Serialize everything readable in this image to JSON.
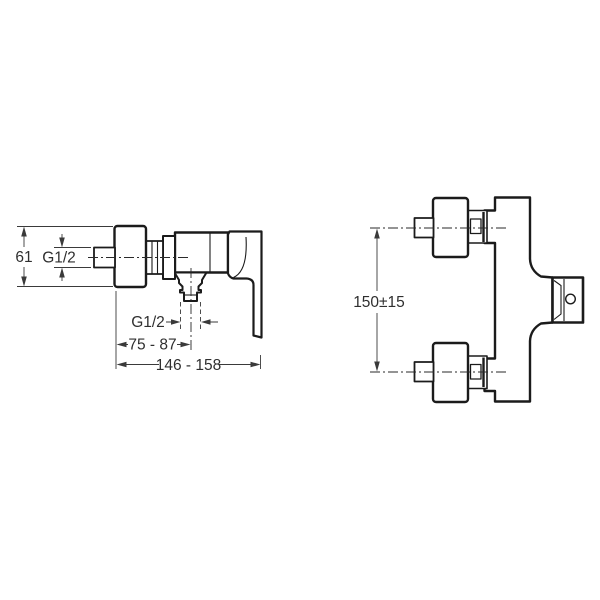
{
  "page": {
    "background": "#ffffff"
  },
  "drawing": {
    "line_color": "#1b1b1b",
    "text_color": "#2f2f2f",
    "side_view": {
      "dim_flange_height": "61",
      "dim_inlet_thread": "G1/2",
      "dim_outlet_thread": "G1/2",
      "dim_outlet_offset": "75 - 87",
      "dim_overall_depth": "146 - 158"
    },
    "front_view": {
      "dim_inlet_spacing": "150±15"
    }
  }
}
